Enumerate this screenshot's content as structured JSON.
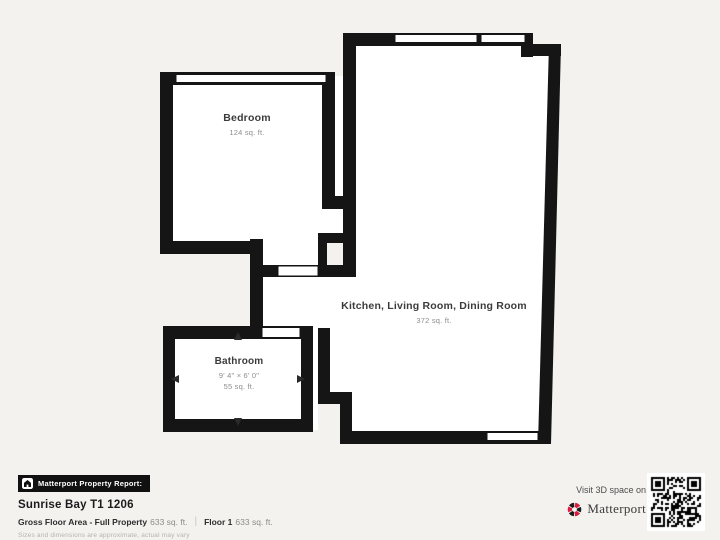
{
  "colors": {
    "background": "#f4f2ef",
    "wall": "#151515",
    "room_fill": "#ffffff",
    "accent_red": "#dc1c3e",
    "badge_bg": "#111111"
  },
  "floor_plan": {
    "rooms": [
      {
        "id": "bedroom",
        "name": "Bedroom",
        "area": "124 sq. ft."
      },
      {
        "id": "kitchen_living_dining",
        "name": "Kitchen, Living Room, Dining Room",
        "area": "372 sq. ft."
      },
      {
        "id": "bathroom",
        "name": "Bathroom",
        "dimensions": "9' 4\" × 6' 0\"",
        "area": "55 sq. ft."
      }
    ]
  },
  "footer": {
    "badge_label": "Matterport Property Report:",
    "property_title": "Sunrise Bay T1 1206",
    "gross_floor_area_label": "Gross Floor Area - Full Property",
    "gross_floor_area_value": "633 sq. ft.",
    "divider": "|",
    "floor_label": "Floor 1",
    "floor_value": "633 sq. ft.",
    "disclaimer": "Sizes and dimensions are approximate, actual may vary"
  },
  "promo": {
    "visit_text": "Visit 3D space on",
    "brand_name": "Matterport"
  }
}
